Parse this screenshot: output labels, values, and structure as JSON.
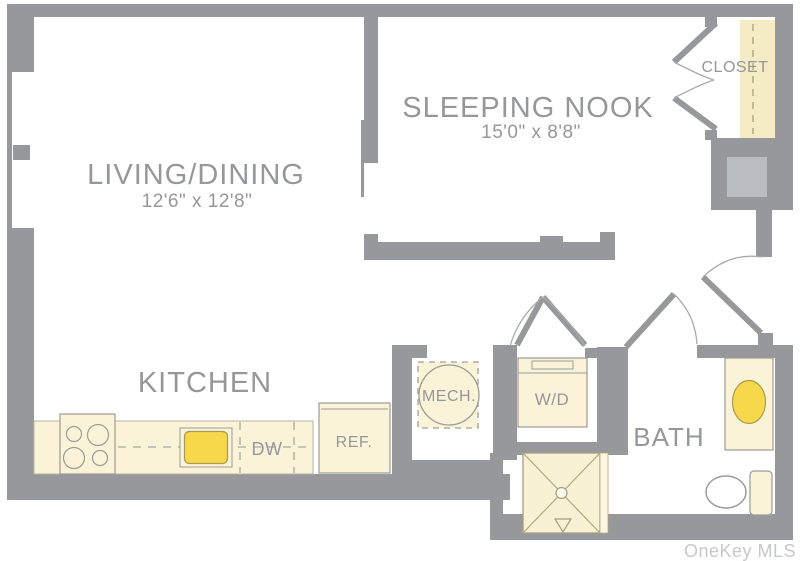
{
  "plan": {
    "type": "apartment-floor-plan",
    "colors": {
      "wall": "#97989b",
      "fixture_fill": "#faf3d8",
      "closet_fill": "#f5ecc6",
      "accent_yellow": "#f7d84b",
      "shaft_gray": "#b9bdc1",
      "label_text": "#96979a",
      "watermark_text": "#c3c6cb"
    },
    "rooms": {
      "living": {
        "name": "LIVING/DINING",
        "dimensions": "12'6\" x 12'8\""
      },
      "sleeping_nook": {
        "name": "SLEEPING NOOK",
        "dimensions": "15'0\" x 8'8\""
      },
      "kitchen": {
        "name": "KITCHEN"
      },
      "bath": {
        "name": "BATH"
      },
      "closet": {
        "name": "CLOSET"
      }
    },
    "fixtures": {
      "mech": "MECH.",
      "washer_dryer": "W/D",
      "dishwasher": "DW",
      "refrigerator": "REF."
    },
    "watermark": "OneKey MLS"
  }
}
